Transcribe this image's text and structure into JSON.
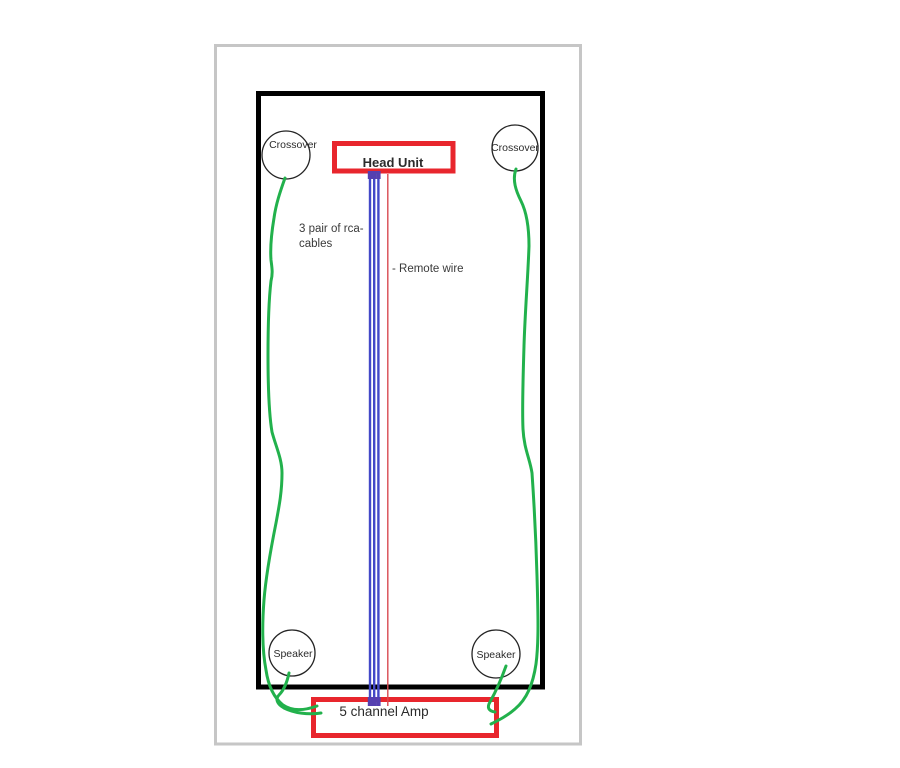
{
  "head_unit": {
    "label": "Head Unit"
  },
  "amp": {
    "label": "5 channel Amp"
  },
  "components": {
    "crossover_left": {
      "label": "Crossover"
    },
    "crossover_right": {
      "label": "Crossover"
    },
    "speaker_left": {
      "label": "Speaker"
    },
    "speaker_right": {
      "label": "Speaker"
    }
  },
  "annotations": {
    "rca_line1": "3 pair of rca-",
    "rca_line2": "cables",
    "remote": "- Remote wire"
  },
  "colors": {
    "box_red": "#e8262d",
    "wire_green": "#22b14c",
    "rca_blue": "#4348c8",
    "cap_purple": "#5540b0",
    "remote_red": "#d94a50",
    "frame_black": "#000000",
    "frame_gray": "#c6c6c6",
    "text_dark": "#2b2b2b"
  }
}
